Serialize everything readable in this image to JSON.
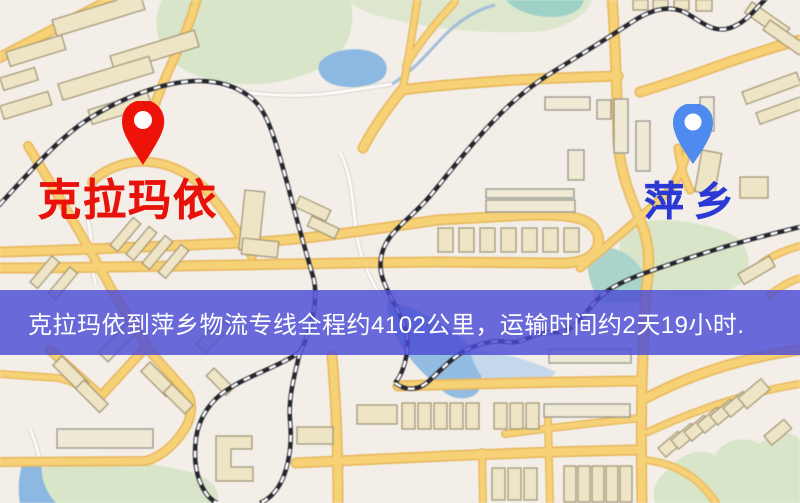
{
  "map": {
    "origin": {
      "name": "克拉玛依",
      "pin_color": "#ee1309",
      "label_color": "#e8120b"
    },
    "destination": {
      "name": "萍乡",
      "pin_color": "#4f8bee",
      "label_color": "#2c39d4"
    },
    "banner": {
      "text": "克拉玛依到萍乡物流专线全程约4102公里，运输时间约2天19小时.",
      "bg_color": "#4c4cd6",
      "text_color": "#ffffff",
      "distance_km": "4102",
      "duration": "2天19小时"
    }
  }
}
